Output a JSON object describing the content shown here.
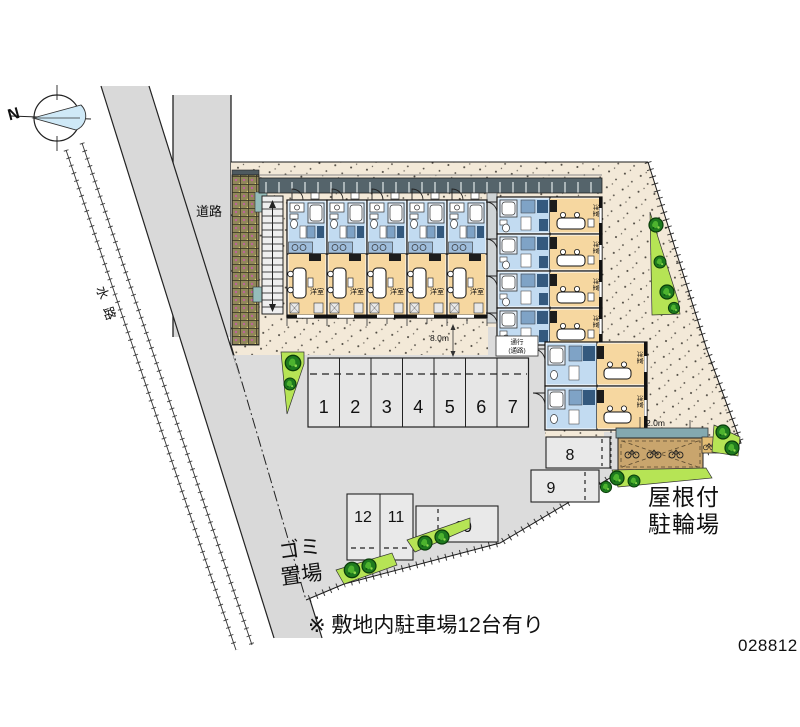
{
  "meta": {
    "plan_number": "028812",
    "note": "※ 敷地内駐車場12台有り"
  },
  "compass": {
    "label": "N"
  },
  "roads": {
    "vertical_road_label": "道路",
    "waterway_label": "水路"
  },
  "areas": {
    "garbage": {
      "line1": "ゴミ",
      "line2": "置場"
    },
    "bike_shelter": {
      "line1": "屋根付",
      "line2": "駐輪場"
    },
    "walkway_sign": {
      "line1": "通行",
      "line2": "(通路)"
    }
  },
  "dimensions": {
    "frontage": "8.0m",
    "bike_depth": "2.0m"
  },
  "building": {
    "room_label": "洋室",
    "left_wing_units": 5,
    "right_wing_units": 4,
    "south_wing_units": 2
  },
  "parking": {
    "numbers": [
      "1",
      "2",
      "3",
      "4",
      "5",
      "6",
      "7",
      "8",
      "9",
      "10",
      "11",
      "12"
    ],
    "total_spaces": 12
  },
  "colors": {
    "ground_gray": "#dcdcdc",
    "walkway_cream": "#f3e9d8",
    "room_tan": "#f6d7a0",
    "wet_area_blue": "#c2dbf1",
    "corridor_dark": "#55646b",
    "greenery_light": "#b6e455",
    "greenery_dark": "#1e7a1e",
    "bike_roof_teal": "#84a9b0",
    "bike_ground_brown": "#c9a56d",
    "retaining_wall_brown": "#91875a",
    "compass_blue": "#cfe9f7"
  }
}
